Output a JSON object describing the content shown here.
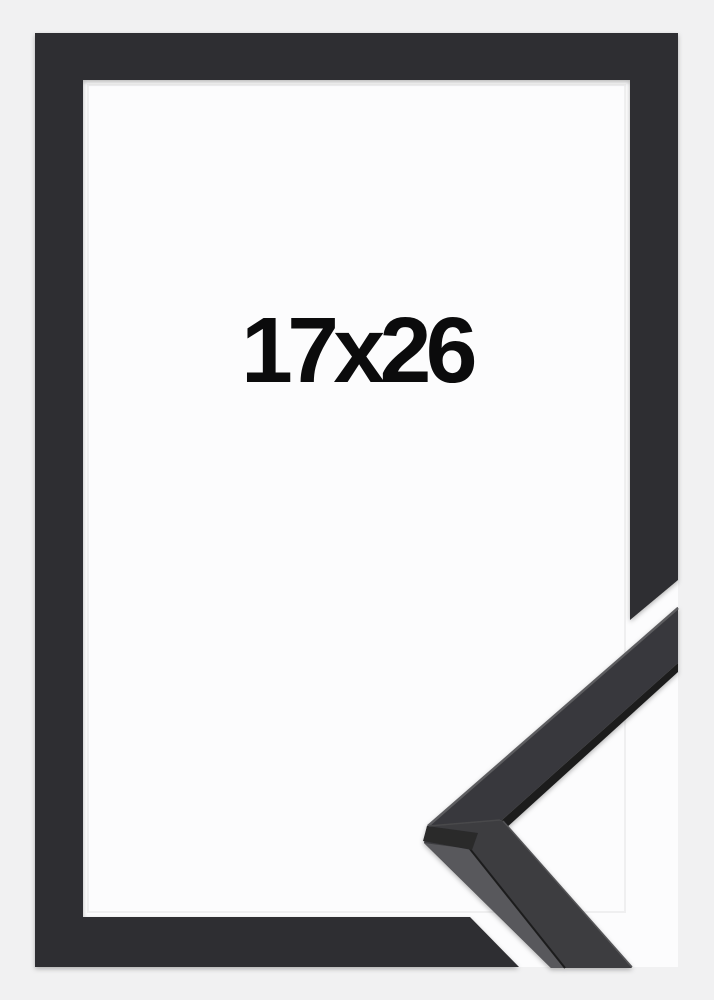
{
  "product": {
    "size_label": "17x26"
  },
  "graphic": {
    "frame": "black picture frame, front view",
    "corner_sample": "moulding corner profile sample, bottom-right"
  },
  "colors": {
    "bg": "#f1f1f2",
    "white": "#fcfcfd",
    "frame": "#2e2e30",
    "sampleTopUpper": "#39393c",
    "sampleTopLower": "#3c3c3f",
    "sampleSide": "#58585b",
    "sampleFacet": "#29292c",
    "edgeDark": "#1d1d1f",
    "hlTop": "#5d5d60",
    "hlRight": "#525255",
    "seam": "#48484b",
    "text": "#0b0b0c"
  }
}
